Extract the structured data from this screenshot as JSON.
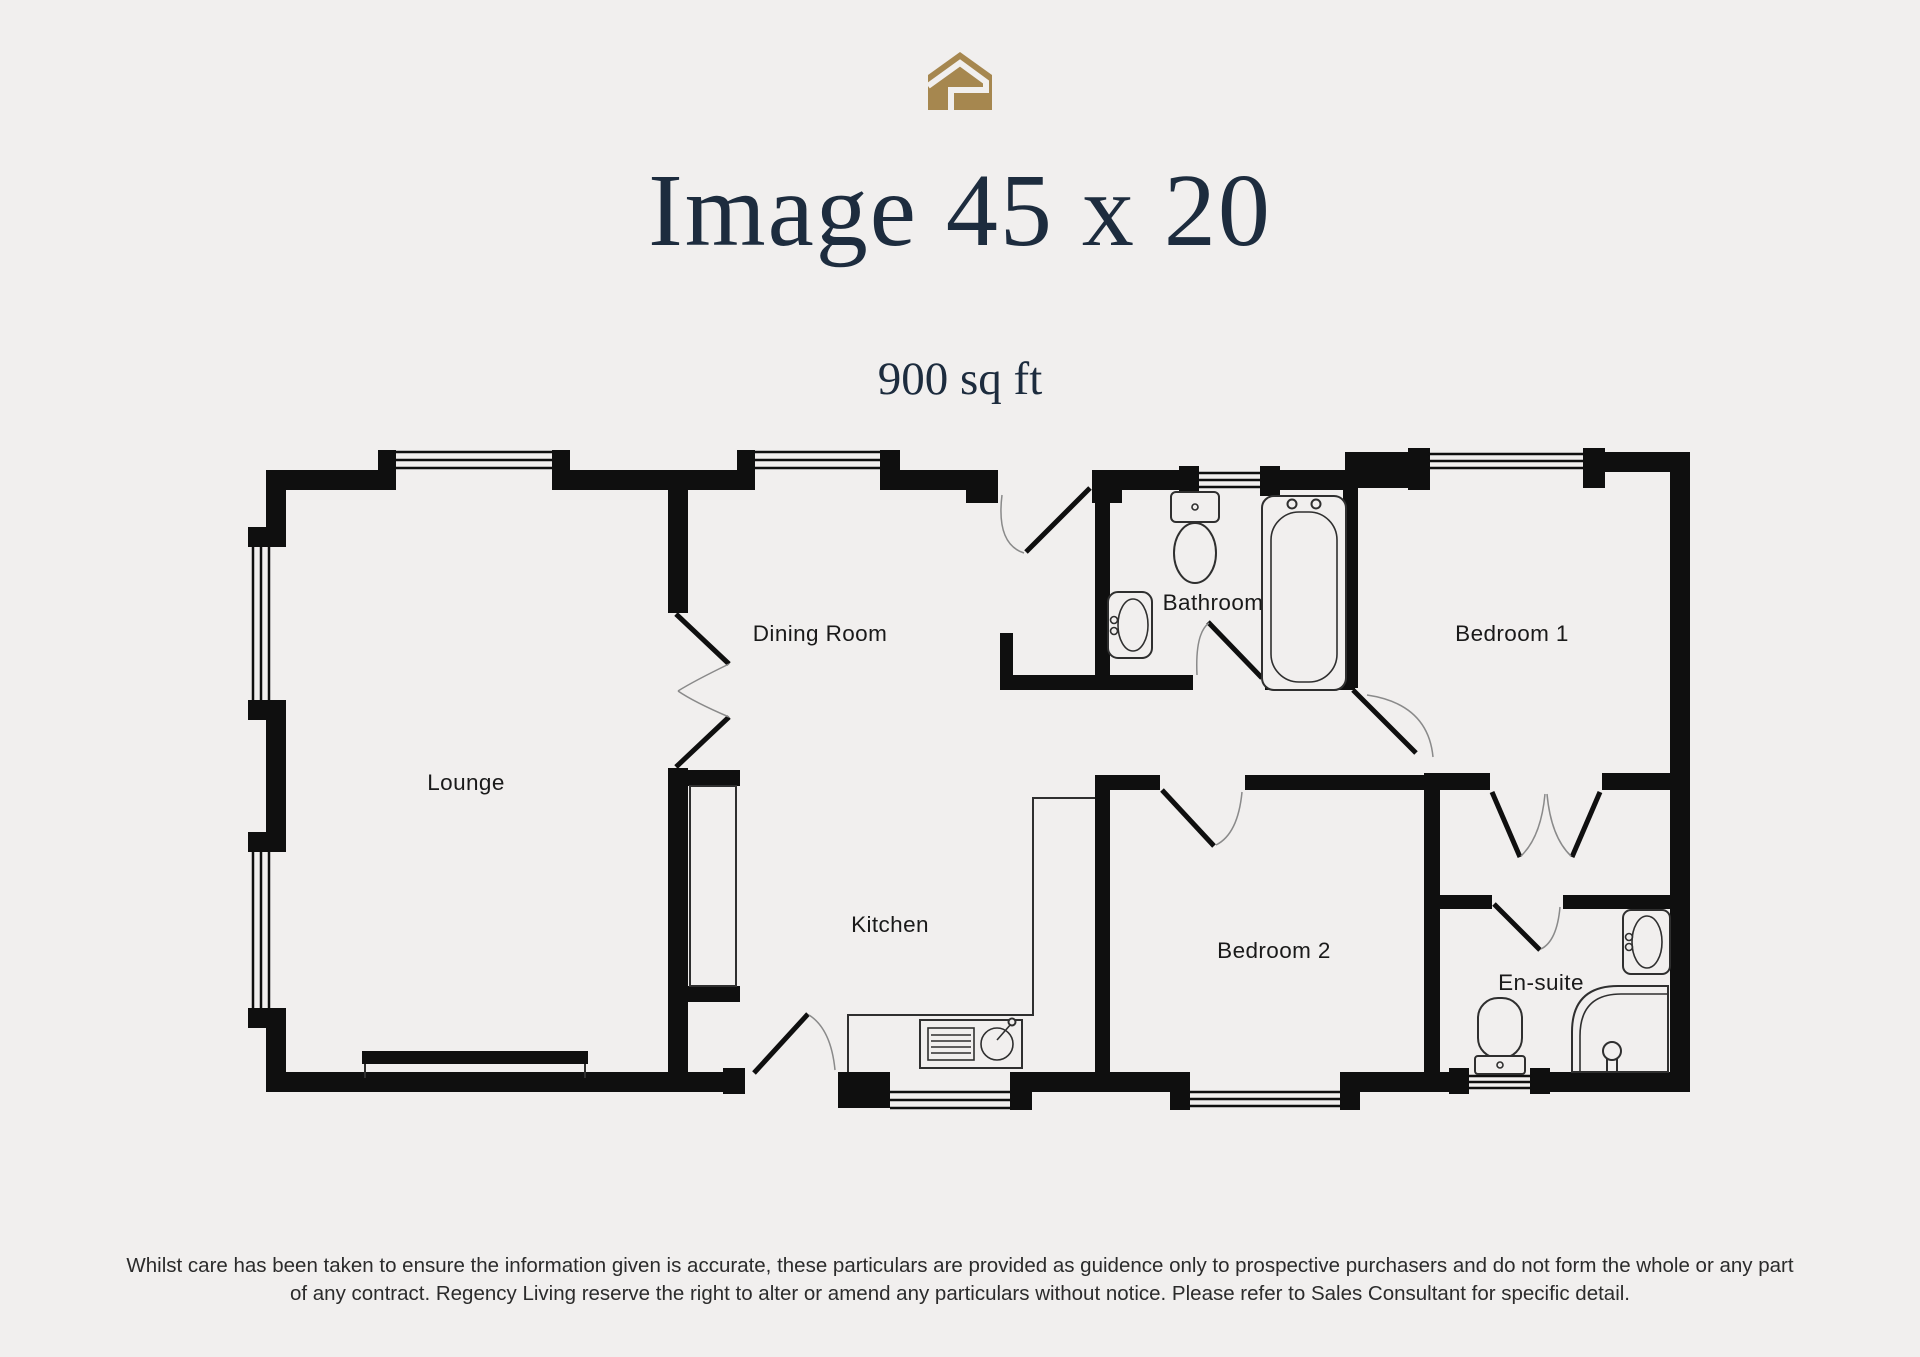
{
  "page": {
    "background_color": "#f1efee",
    "accent_gold": "#a6874f",
    "title_navy": "#1d2c3e",
    "wall_color": "#0f0f0f"
  },
  "logo": {
    "name": "regency-living-house-logo"
  },
  "header": {
    "title": "Image 45 x 20",
    "subtitle": "900 sq ft"
  },
  "plan": {
    "rooms": [
      {
        "label": "Lounge"
      },
      {
        "label": "Dining Room"
      },
      {
        "label": "Kitchen"
      },
      {
        "label": "Bathroom"
      },
      {
        "label": "Bedroom 1"
      },
      {
        "label": "Bedroom 2"
      },
      {
        "label": "En-suite"
      }
    ]
  },
  "footer": {
    "line1": "Whilst care has been taken to ensure the information given is accurate, these particulars are provided as guidence only to prospective purchasers and do not form the whole or any part",
    "line2": "of any contract. Regency Living reserve the right to alter or amend any particulars without notice. Please refer to Sales Consultant for specific detail."
  }
}
